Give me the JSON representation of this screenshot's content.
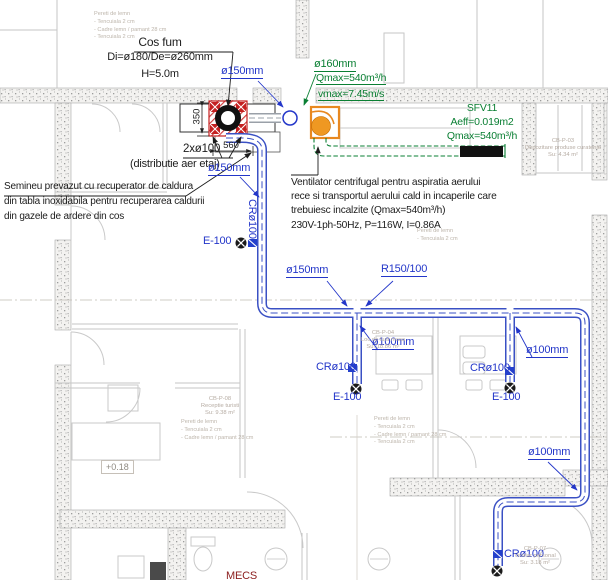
{
  "drawing": {
    "chimney_note": {
      "line1": "Cos fum",
      "line2": "Di=ø180/De=ø260mm",
      "line3": "H=5.0m"
    },
    "dims": {
      "width": "560",
      "height": "350"
    },
    "distribution_note": {
      "line1": "2xø100",
      "line2": "(distributie aer etaj)"
    },
    "fireplace_note": {
      "line1": "Semineu prevazut cu recuperator de caldura",
      "line2": "din tabla inoxidabila pentru recuperarea caldurii",
      "line3": "din gazele de ardere din cos"
    },
    "fan_note": {
      "line1": "Ventilator centrifugal pentru aspiratia aerului",
      "line2": "rece si transportul aerului cald in incaperile care",
      "line3": "trebuiesc incalzite (Qmax=540m³/h)",
      "electrical": "230V-1ph-50Hz, P=116W, I=0.86A"
    },
    "supply_duct": {
      "diameter": "ø160mm",
      "flow": "Qmax=540m³/h",
      "velocity": "vmax=7.45m/s"
    },
    "grille": {
      "model": "SFV11",
      "area": "Aeff=0.019m2",
      "flow": "Qmax=540m³/h"
    },
    "duct_labels": {
      "d150_top": "ø150mm",
      "d150_left": "ø150mm",
      "d150_mid": "ø150mm",
      "reducer": "R150/100",
      "d100_mid": "ø100mm",
      "d100_right": "ø100mm",
      "d100_bottom": "ø100mm",
      "cr_left": "CRø100",
      "cr_mid": "CRø100",
      "cr_right": "CRø100",
      "cr_bottom": "CRø100",
      "e_left": "E-100",
      "e_mid": "E-100",
      "e_right": "E-100"
    },
    "level_marker": "+0.18",
    "system_tag": "MECS",
    "rooms": {
      "storage": {
        "code": "CB-P-03",
        "name": "Depozitare produse curatenie",
        "area": "Su: 4.34 m²"
      },
      "dining": {
        "code": "CB-P-04",
        "name": "Loc de luat masa",
        "area": "Su: 18.86 m²"
      },
      "reception": {
        "code": "CB-P-08",
        "name": "Receptie turisti",
        "area": "Su: 9.38 m²"
      },
      "locker": {
        "code": "CB-P-07",
        "name": "Vestiar personal",
        "area": "Su: 3.18 m²"
      }
    },
    "wall_note": {
      "line1": "Pereti de lemn",
      "line2": "- Tencuiala 2 cm",
      "line3": "- Cadre lemn / pamant 28 cm",
      "line4": "- Tencuiala 2 cm"
    },
    "colors": {
      "duct_blue": "#2336c9",
      "supply_green": "#0a7f33",
      "alert_red": "#e01212",
      "grille_red": "#c42020",
      "fan_orange": "#e8881f"
    }
  }
}
